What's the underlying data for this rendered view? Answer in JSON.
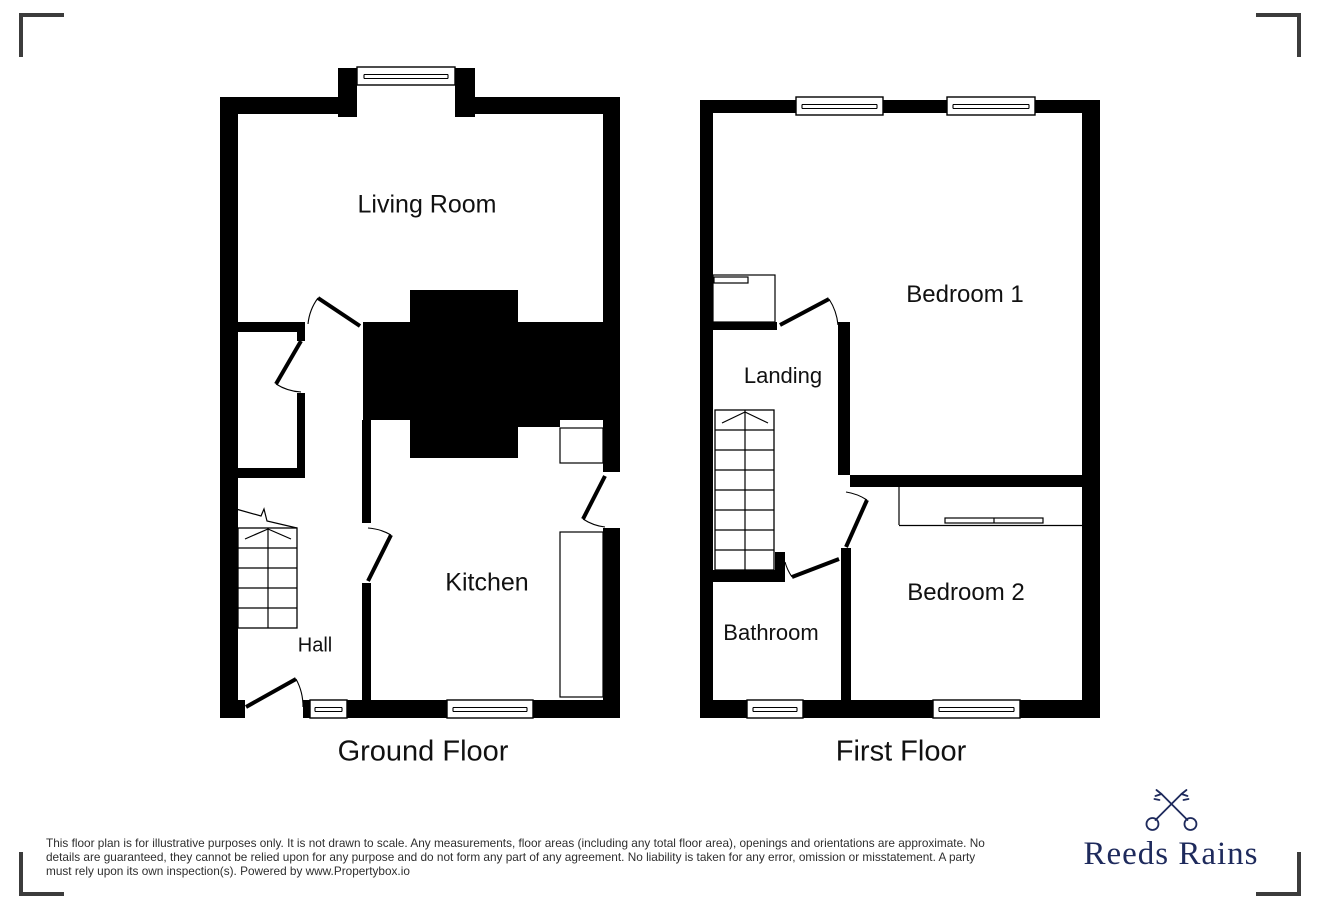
{
  "ground_floor": {
    "title": "Ground Floor",
    "rooms": {
      "living_room": "Living Room",
      "kitchen": "Kitchen",
      "hall": "Hall"
    }
  },
  "first_floor": {
    "title": "First Floor",
    "rooms": {
      "bedroom1": "Bedroom 1",
      "bedroom2": "Bedroom 2",
      "landing": "Landing",
      "bathroom": "Bathroom"
    }
  },
  "disclaimer": {
    "line1": "This floor plan is for illustrative purposes only. It is not drawn to scale. Any measurements, floor areas (including any total floor area), openings and orientations are approximate. No",
    "line2": "details are guaranteed, they cannot be relied upon for any purpose and do not form any part of any agreement. No liability is taken for any error, omission or misstatement. A party",
    "line3": "must rely upon its own inspection(s). Powered by www.Propertybox.io"
  },
  "brand": {
    "name": "Reeds Rains",
    "icon": "crossed-keys-icon",
    "color": "#1e2a5c"
  },
  "colors": {
    "wall": "#000000",
    "corner_mark": "#3c3c3c",
    "label_text": "#111111",
    "disclaimer_text": "#2e2e2e"
  }
}
